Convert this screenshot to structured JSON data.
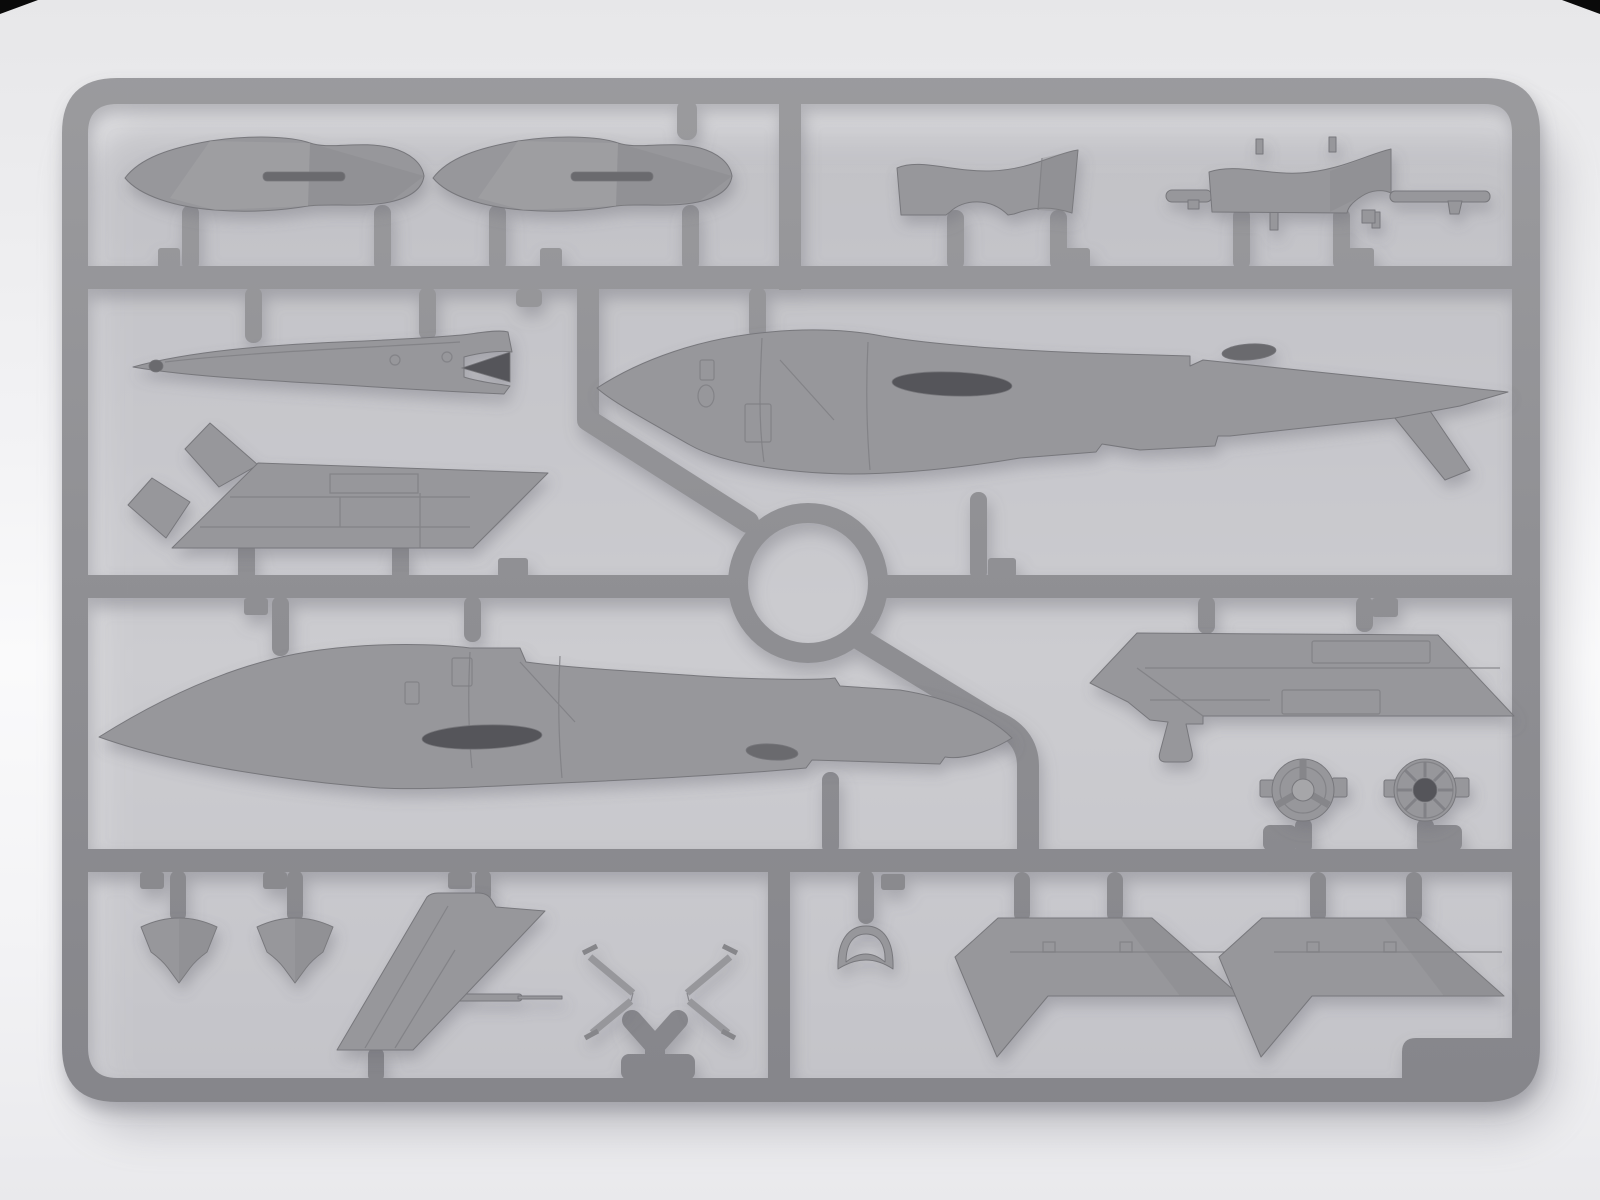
{
  "scene": {
    "kind": "product-photo-render",
    "subject": "Gray injection-molded plastic model kit sprue (parts tree) for a jet target drone, photographed on a light studio background",
    "material": "gray styrene plastic",
    "text_visible": "",
    "layout": "rectangular runner frame with one center ring runner, three horizontal rails and internal gates holding 18 parts"
  },
  "palette": {
    "bg_top": "#e7e7e9",
    "bg_mid": "#f3f3f5",
    "bg_hi": "#fafafb",
    "bg_bottom": "#e9e9ec",
    "runner": "#8f8f93",
    "runner_hi": "#9b9b9e",
    "runner_lo": "#85858a",
    "part": "#97979b",
    "part_dark": "#86868a",
    "part_light": "#a6a6a9",
    "outline": "#77777b",
    "panel_line": "#7f7f84",
    "hole_dark": "#55555a",
    "hole_mid": "#6a6a6e",
    "shadow": "#6e6e78",
    "corner_mark": "#0a0a0a"
  },
  "sprue": {
    "frame": {
      "corner_radius_px": 55,
      "bar_thickness_px": 24,
      "horizontal_rails": 3,
      "center_ring": true,
      "vertical_dividers": 2
    },
    "parts": [
      {
        "id": "drop-tank-half-1",
        "location": "top-left"
      },
      {
        "id": "drop-tank-half-2",
        "location": "top-left"
      },
      {
        "id": "intake-cowl-half-left",
        "location": "top-right"
      },
      {
        "id": "intake-cowl-half-right-with-rods",
        "location": "top-right"
      },
      {
        "id": "nose-boom",
        "location": "second-row-left"
      },
      {
        "id": "dorsal-hatch-panel",
        "location": "second-row-left"
      },
      {
        "id": "fuselage-half-right",
        "location": "second-row-right"
      },
      {
        "id": "fuselage-half-left",
        "location": "third-row-left"
      },
      {
        "id": "main-wing-half",
        "location": "third-row-right"
      },
      {
        "id": "wheel-hub-spoked",
        "location": "third-row-right"
      },
      {
        "id": "wheel-hub-ribbed",
        "location": "third-row-right"
      },
      {
        "id": "shield-fairing-1",
        "location": "bottom-left"
      },
      {
        "id": "shield-fairing-2",
        "location": "bottom-left"
      },
      {
        "id": "vertical-fin-with-pitot",
        "location": "bottom-left"
      },
      {
        "id": "antenna-strut-left",
        "location": "bottom-center"
      },
      {
        "id": "antenna-strut-right",
        "location": "bottom-center"
      },
      {
        "id": "windscreen-frame",
        "location": "bottom-center"
      },
      {
        "id": "stabilizer-half-1",
        "location": "bottom-right"
      },
      {
        "id": "stabilizer-half-2",
        "location": "bottom-right"
      }
    ]
  }
}
